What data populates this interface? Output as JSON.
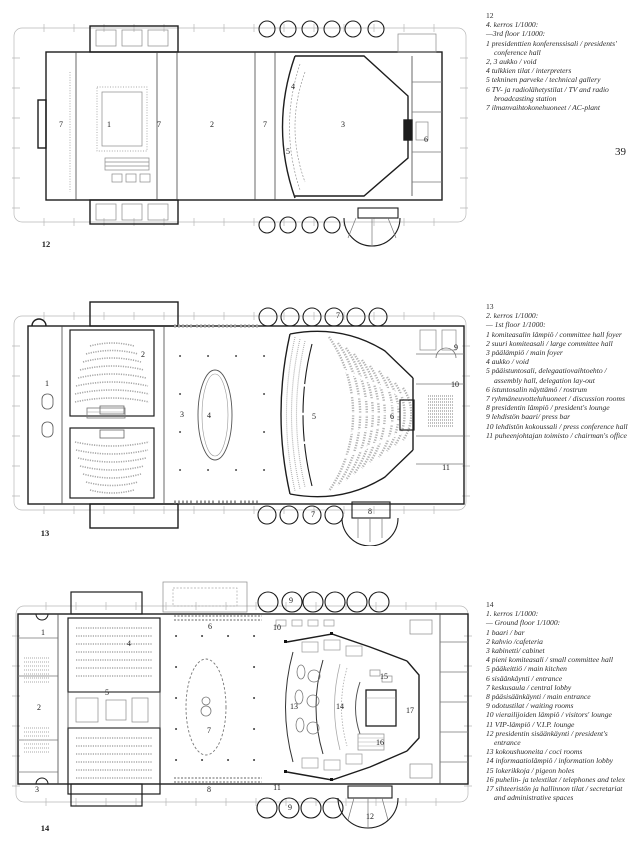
{
  "page": {
    "number": "39"
  },
  "legends": [
    {
      "figure": "12",
      "title_fi": "4. kerros 1/1000:",
      "title_en": "—3rd floor 1/1000:",
      "items": [
        "1 presidenttien konferenssisali / presidents' conference hall",
        "2, 3 aukko / void",
        "4 tulkkien tilat / interpreters",
        "5 tekninen parveke / technical gallery",
        "6 TV- ja radiolähetystilat / TV and radio broadcasting station",
        "7 ilmanvaihtokonehuoneet / AC-plant"
      ]
    },
    {
      "figure": "13",
      "title_fi": "2. kerros 1/1000:",
      "title_en": "— 1st floor 1/1000:",
      "items": [
        "1 komiteasalin lämpiö / committee hall foyer",
        "2 suuri komiteasali / large committee hall",
        "3 päälämpiö / main foyer",
        "4 aukko / void",
        "5 pääistuntosali, delegaatiovaihtoehto / assembly hall, delegation lay-out",
        "6 istuntosalin näyttämö / rostrum",
        "7 ryhmäneuvotteluhuoneet / discussion rooms",
        "8 presidentin lämpiö / president's lounge",
        "9 lehdistön baari/ press bar",
        "10 lehdistön kokoussali / press conference hall",
        "11 puheenjohtajan toimisto / chairman's office"
      ]
    },
    {
      "figure": "14",
      "title_fi": "1. kerros 1/1000:",
      "title_en": "— Ground floor 1/1000:",
      "items": [
        "1 baari / bar",
        "2 kahvio /cafeteria",
        "3 kabinetti/ cabinet",
        "4 pieni komiteasali / small committee hall",
        "5 pääkeittiö / main kitchen",
        "6 sisäänkäynti / entrance",
        "7 keskusaula / central lobby",
        "8 pääsisäänkäynti / main entrance",
        "9 odotustilat / waiting rooms",
        "10 vierailijoiden lämpiö / visitors' lounge",
        "11 VIP-lämpiö / V.I.P. lounge",
        "12 presidentin sisäänkäynti / president's entrance",
        "13 kokoushuoneita / coci rooms",
        "14 informaatiolämpiö / information lobby",
        "15 lokerikkoja / pigeon holes",
        "16 puhelin- ja telextilat / telephones and telex",
        "17 sihteeristön ja hallinnon tilat / secretariat and administrative spaces"
      ]
    }
  ],
  "plans": [
    {
      "figure": "12",
      "labels": [
        {
          "t": "7",
          "x": 49,
          "y": 113
        },
        {
          "t": "1",
          "x": 97,
          "y": 113
        },
        {
          "t": "7",
          "x": 147,
          "y": 113
        },
        {
          "t": "2",
          "x": 200,
          "y": 113
        },
        {
          "t": "7",
          "x": 253,
          "y": 113
        },
        {
          "t": "4",
          "x": 281,
          "y": 75
        },
        {
          "t": "5",
          "x": 276,
          "y": 140
        },
        {
          "t": "3",
          "x": 331,
          "y": 113
        },
        {
          "t": "6",
          "x": 414,
          "y": 128
        },
        {
          "t": "12",
          "x": 34,
          "y": 232,
          "fig": true
        }
      ]
    },
    {
      "figure": "13",
      "labels": [
        {
          "t": "1",
          "x": 35,
          "y": 88
        },
        {
          "t": "2",
          "x": 131,
          "y": 59
        },
        {
          "t": "3",
          "x": 170,
          "y": 119
        },
        {
          "t": "4",
          "x": 197,
          "y": 120
        },
        {
          "t": "5",
          "x": 302,
          "y": 121
        },
        {
          "t": "6",
          "x": 380,
          "y": 121
        },
        {
          "t": "7",
          "x": 326,
          "y": 20
        },
        {
          "t": "7",
          "x": 301,
          "y": 219
        },
        {
          "t": "8",
          "x": 358,
          "y": 216
        },
        {
          "t": "9",
          "x": 444,
          "y": 52
        },
        {
          "t": "10",
          "x": 443,
          "y": 89
        },
        {
          "t": "11",
          "x": 434,
          "y": 172
        },
        {
          "t": "13",
          "x": 33,
          "y": 237,
          "fig": true
        }
      ]
    },
    {
      "figure": "14",
      "labels": [
        {
          "t": "1",
          "x": 33,
          "y": 53
        },
        {
          "t": "2",
          "x": 29,
          "y": 128
        },
        {
          "t": "3",
          "x": 27,
          "y": 210
        },
        {
          "t": "4",
          "x": 119,
          "y": 64
        },
        {
          "t": "5",
          "x": 97,
          "y": 113
        },
        {
          "t": "6",
          "x": 200,
          "y": 47
        },
        {
          "t": "7",
          "x": 199,
          "y": 151
        },
        {
          "t": "8",
          "x": 199,
          "y": 210
        },
        {
          "t": "9",
          "x": 281,
          "y": 21
        },
        {
          "t": "10",
          "x": 267,
          "y": 48
        },
        {
          "t": "9",
          "x": 280,
          "y": 228
        },
        {
          "t": "11",
          "x": 267,
          "y": 208
        },
        {
          "t": "12",
          "x": 360,
          "y": 237
        },
        {
          "t": "13",
          "x": 284,
          "y": 127
        },
        {
          "t": "14",
          "x": 330,
          "y": 127
        },
        {
          "t": "15",
          "x": 374,
          "y": 97
        },
        {
          "t": "16",
          "x": 370,
          "y": 163
        },
        {
          "t": "17",
          "x": 400,
          "y": 131
        },
        {
          "t": "14",
          "x": 35,
          "y": 248,
          "fig": true
        }
      ]
    }
  ]
}
